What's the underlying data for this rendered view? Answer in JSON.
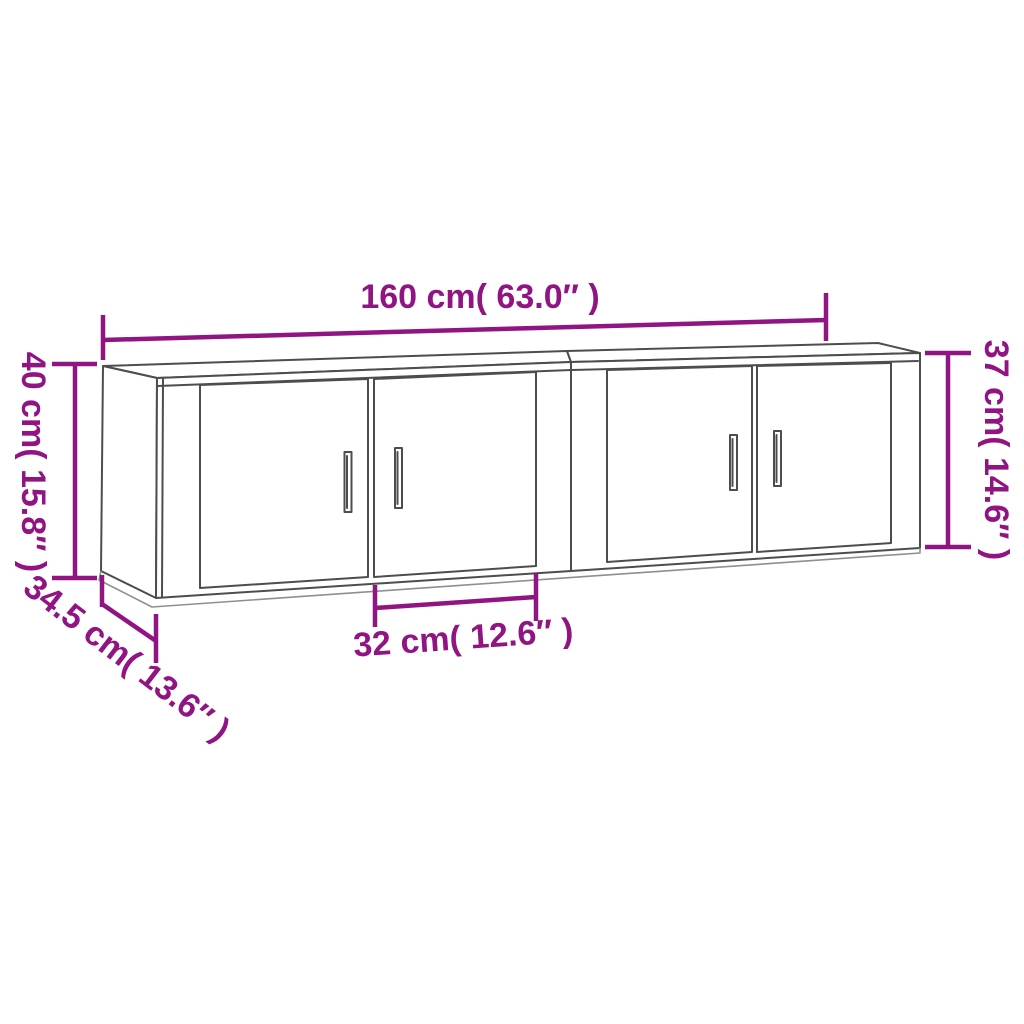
{
  "diagram": {
    "background_color": "#ffffff",
    "drawing_line_color": "#4d4d4d",
    "dimension_color": "#911483"
  },
  "dimensions": {
    "overall_width": "160 cm( 63.0″ )",
    "height_right": "37 cm( 14.6″ )",
    "height_left": "40 cm( 15.8″ )",
    "depth": "34.5 cm( 13.6″ )",
    "door_width": "32 cm( 12.6″ )"
  }
}
